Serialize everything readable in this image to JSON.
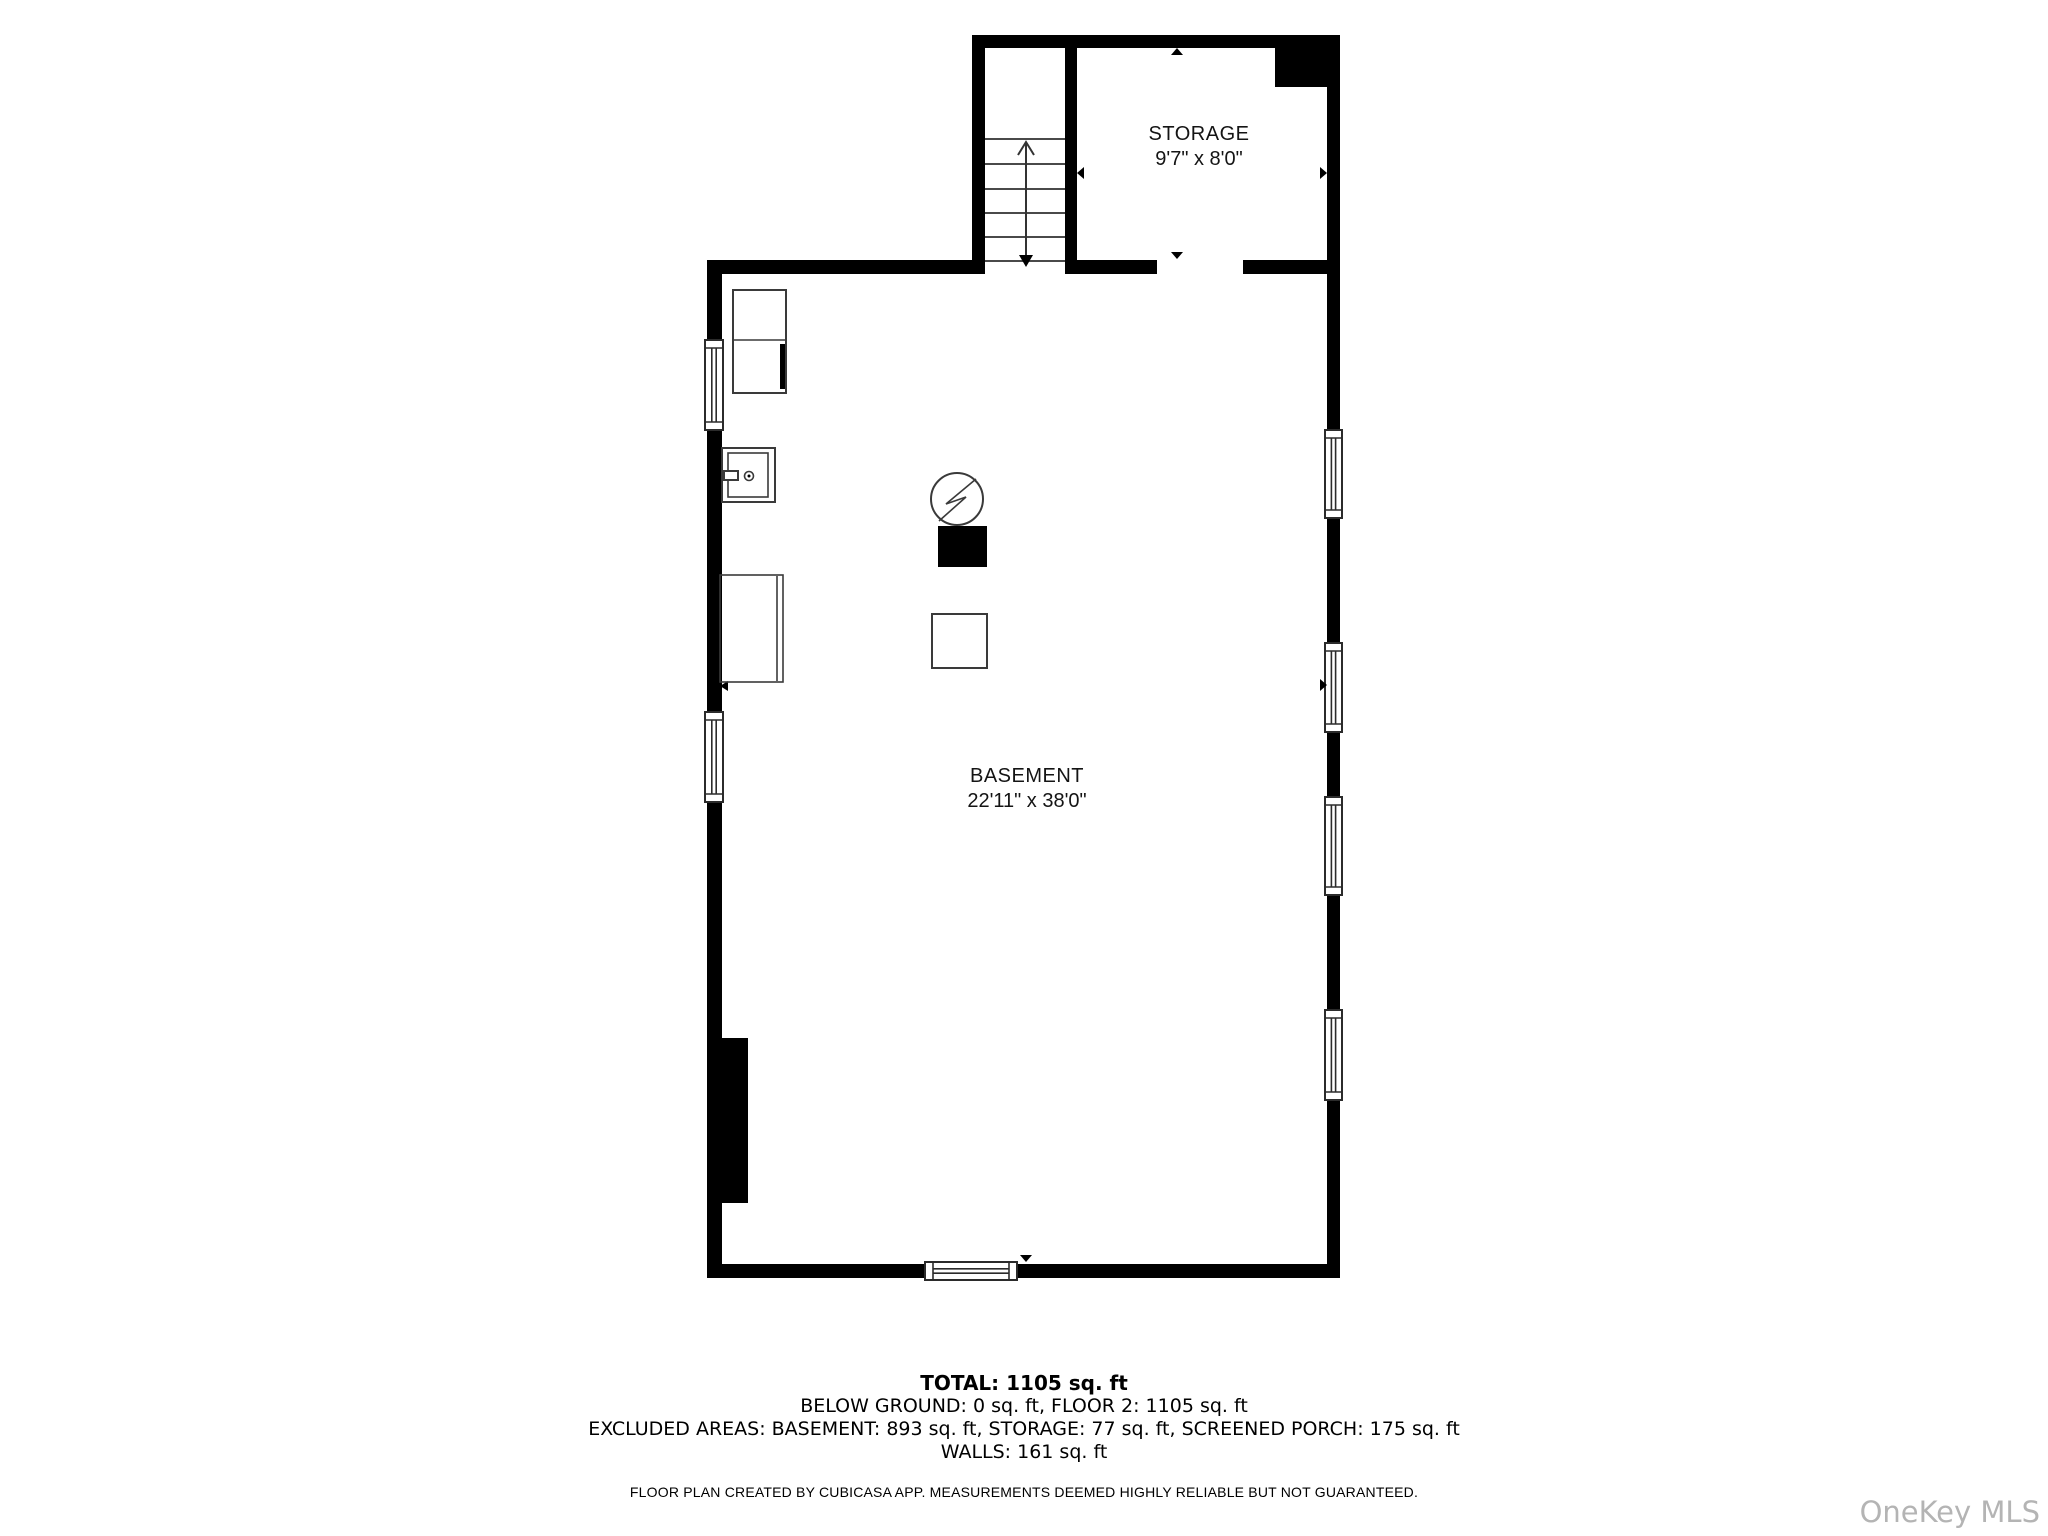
{
  "colors": {
    "wall": "#000000",
    "fixture": "#3a3a3a",
    "watermark": "#b4b4b4"
  },
  "rooms": [
    {
      "name": "STORAGE",
      "dimensions": "9'7\" x 8'0\""
    },
    {
      "name": "BASEMENT",
      "dimensions": "22'11\" x 38'0\""
    }
  ],
  "fixture_icons": [
    "stairs-up-arrow-icon",
    "washer-dryer-icon",
    "utility-sink-icon",
    "water-heater-circle-bolt-icon",
    "black-equipment-box-icon",
    "white-equipment-box-icon",
    "door-opening-arrow-icon"
  ],
  "summary": {
    "total": "TOTAL: 1105 sq. ft",
    "below_ground_floor2": "BELOW GROUND: 0 sq. ft, FLOOR 2: 1105 sq. ft",
    "excluded": "EXCLUDED AREAS: BASEMENT: 893 sq. ft, STORAGE: 77 sq. ft, SCREENED PORCH: 175 sq. ft",
    "walls": "WALLS: 161 sq. ft"
  },
  "disclaimer": "FLOOR PLAN CREATED BY CUBICASA APP. MEASUREMENTS DEEMED HIGHLY RELIABLE BUT NOT GUARANTEED.",
  "watermark": "OneKey MLS"
}
